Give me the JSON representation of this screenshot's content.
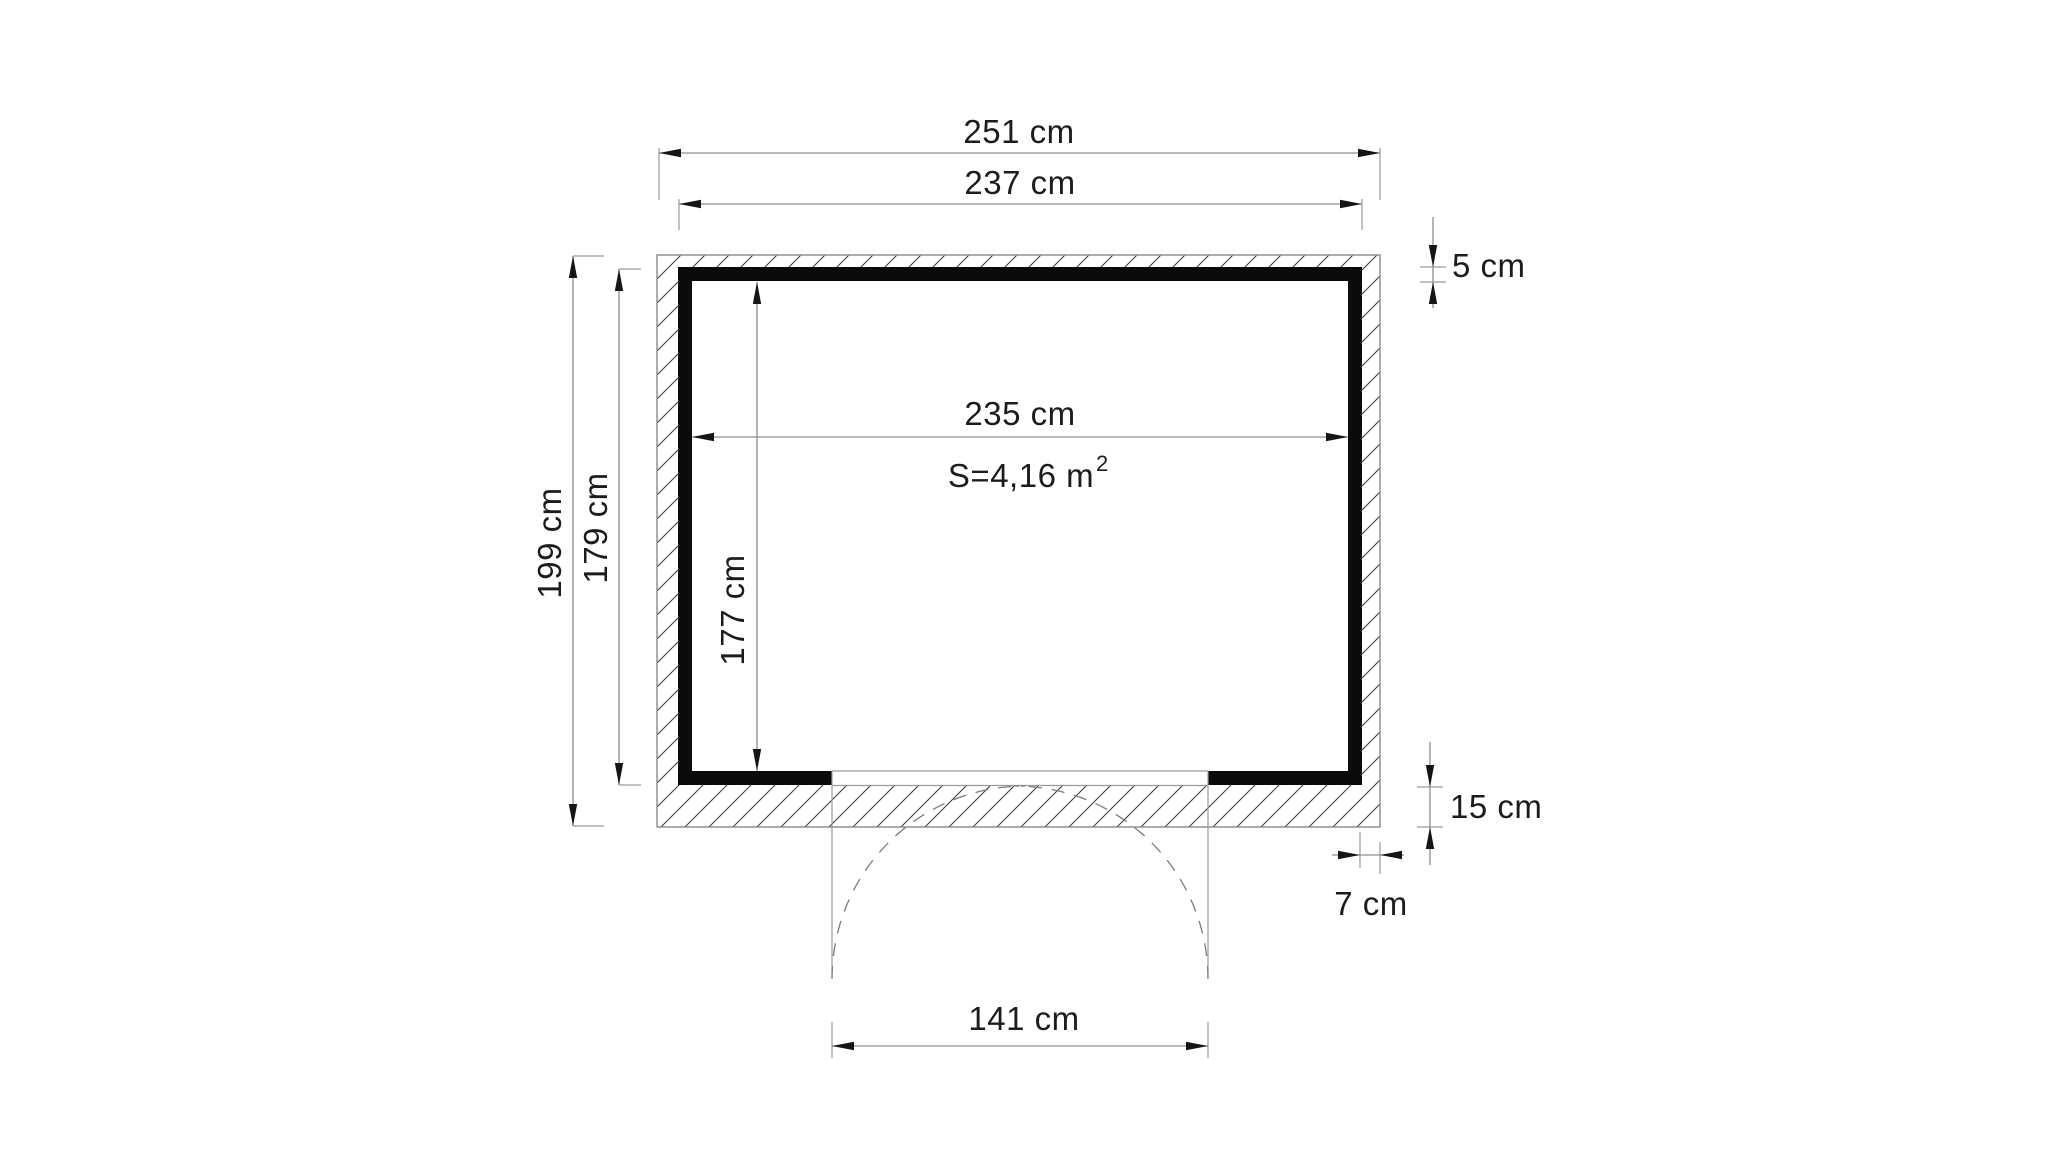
{
  "canvas": {
    "background": "#ffffff",
    "wall_fill": "#0b0b0b",
    "hatch_color": "#3d3d3d",
    "line_color": "#8f8f8f",
    "text_color": "#1c1c1c"
  },
  "floor_plan": {
    "type": "shed-floor-plan-top-view",
    "area_label": "S=4,16 m",
    "area_superscript": "2",
    "dimensions": {
      "outer_width": "251 cm",
      "frame_width": "237 cm",
      "inner_width": "235 cm",
      "outer_depth": "199 cm",
      "frame_depth": "179 cm",
      "inner_depth": "177 cm",
      "wall_liner_thickness": "5 cm",
      "base_thickness": "15 cm",
      "wall_offset": "7 cm",
      "door_width": "141 cm"
    }
  }
}
